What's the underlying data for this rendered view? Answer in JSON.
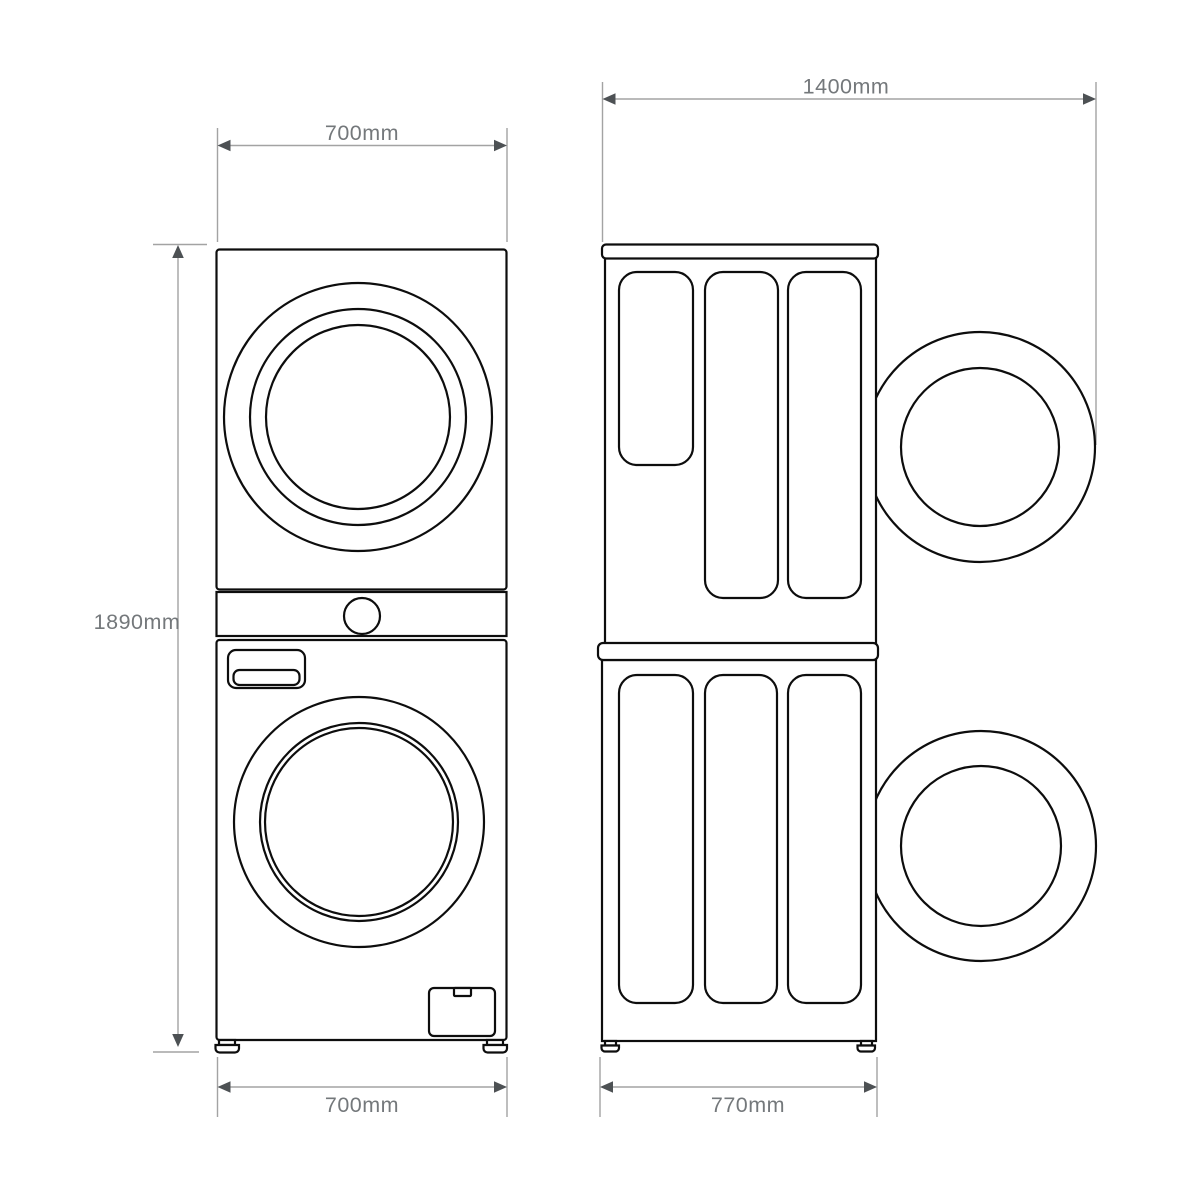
{
  "diagram": {
    "kind": "stacked-washer-dryer-dimension-drawing",
    "dimensions": {
      "front_top_width": "700mm",
      "front_height": "1890mm",
      "front_bottom_width": "700mm",
      "side_depth_door_open": "1400mm",
      "side_bottom_depth": "770mm"
    },
    "colors": {
      "background": "#ffffff",
      "outline": "#0d0d0d",
      "dimension_line": "#a3a3a3",
      "dimension_arrow": "#4d5154",
      "dimension_text": "#74787b"
    }
  }
}
